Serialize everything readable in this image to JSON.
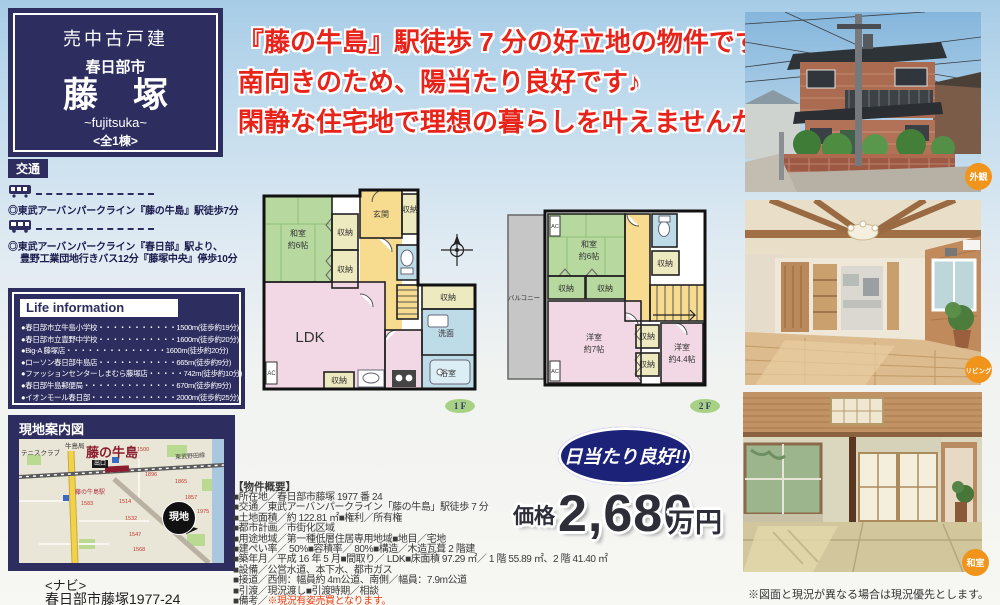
{
  "title_box": {
    "category": "売中古戸建",
    "city": "春日部市",
    "name": "藤　塚",
    "romaji": "~fujitsuka~",
    "units": "<全1棟>"
  },
  "catchphrase": {
    "line1": "『藤の牛島』駅徒歩 7 分の好立地の物件です♪",
    "line2": "南向きのため、陽当たり良好です♪",
    "line3": "閑静な住宅地で理想の暮らしを叶えませんか♪"
  },
  "access": {
    "header": "交通",
    "train_note": "◎東武アーバンパークライン『藤の牛島』駅徒歩7分",
    "bus_note_line1": "◎東武アーバンパークライン『春日部』駅より、",
    "bus_note_line2": "豊野工業団地行きバス12分『藤塚中央』停歩10分"
  },
  "life_info": {
    "title": "Life information",
    "items": [
      "●春日部市立牛島小学校・・・・・・・・・・・1500m(徒歩約19分)",
      "●春日部市立豊野中学校・・・・・・・・・・・1600m(徒歩約20分)",
      "●Big-A 藤塚店・・・・・・・・・・・・・・1600m(徒歩約20分)",
      "●ローソン春日部牛島店・・・・・・・・・・・665m(徒歩約9分)",
      "●ファッションセンターしまむら藤塚店・・・・・742m(徒歩約10分)",
      "●春日部牛島郵便局・・・・・・・・・・・・・670m(徒歩約9分)",
      "●イオンモール春日部・・・・・・・・・・・・2000m(徒歩約25分)"
    ]
  },
  "map": {
    "header": "現地案内図",
    "station_big": "藤の牛島",
    "exit": "出口",
    "tennis": "テニスクラブ",
    "post": "牛島局",
    "station_small": "藤の牛島駅",
    "line_name": "東武野田線",
    "marker": "現地",
    "lot_numbers": [
      "1500",
      "1583",
      "1514",
      "1532",
      "1547",
      "1568",
      "1857",
      "1865",
      "1896",
      "1975"
    ],
    "navi_label": "<ナビ>",
    "navi_address": "春日部市藤塚1977-24"
  },
  "floorplan_1f": {
    "floor_label": "1 F",
    "washitsu": "和室",
    "washitsu_size": "約6帖",
    "shuno": "収納",
    "genkan": "玄関",
    "ldk": "LDK",
    "senmen": "洗面",
    "yokushitsu": "浴室",
    "ac": "AC"
  },
  "floorplan_2f": {
    "floor_label": "2 F",
    "balcony": "バルコニー",
    "washitsu": "和室",
    "washitsu_size": "約6帖",
    "shuno": "収納",
    "yoshitsu7": "洋室",
    "yoshitsu7_size": "約7帖",
    "yoshitsu44": "洋室",
    "yoshitsu44_size": "約4.4帖",
    "ac": "AC"
  },
  "badge": {
    "text": "日当たり良好!!"
  },
  "price": {
    "label": "価格",
    "amount": "2,680",
    "unit": "万円"
  },
  "summary": {
    "header": "【物件概要】",
    "lines": [
      "■所在地／春日部市藤塚 1977 番 24",
      "■交通／東武アーバンパークライン「藤の牛島」駅徒歩 7 分",
      "■土地面積／約 122.81 ㎡■権利／所有権",
      "■都市計画／市街化区域",
      "■用途地域／第一種低層住居専用地域■地目／宅地",
      "■建ぺい率／ 50%■容積率／ 80%■構造／木造瓦葺 2 階建",
      "■築年月／平成 16 年 5 月■間取り／ LDK■床面積 97.29 ㎡／ 1 階 55.89 ㎡、2 階 41.40 ㎡",
      "■設備／公営水道、本下水、都市ガス",
      "■接道／西側：幅員約 4m公道、南側／幅員：7.9m公道",
      "■引渡／現況渡し■引渡時期／相談"
    ],
    "remarks_prefix": "■備考／",
    "remark1": "※現況有姿売買となります。",
    "remark2": "※建物契約不適合責任は免責となります。"
  },
  "photos": [
    {
      "label": "外観"
    },
    {
      "label": "リビング"
    },
    {
      "label": "和室"
    }
  ],
  "disclaimer": "※図面と現況が異なる場合は現況優先とします。",
  "colors": {
    "navy": "#2d2d5f",
    "catch_red": "#e8231a",
    "remark_red": "#ea3c0f",
    "badge_navy": "#1c2277",
    "photo_label_orange": "#f0941c",
    "price_text": "#2e2e38",
    "map_station_red": "#8c1d30",
    "fp_green": "#b7d89f",
    "fp_pink": "#f2d8e4",
    "fp_yellow": "#f7db8e",
    "fp_blue": "#bedbe8",
    "fp_cream": "#eeeac0"
  }
}
